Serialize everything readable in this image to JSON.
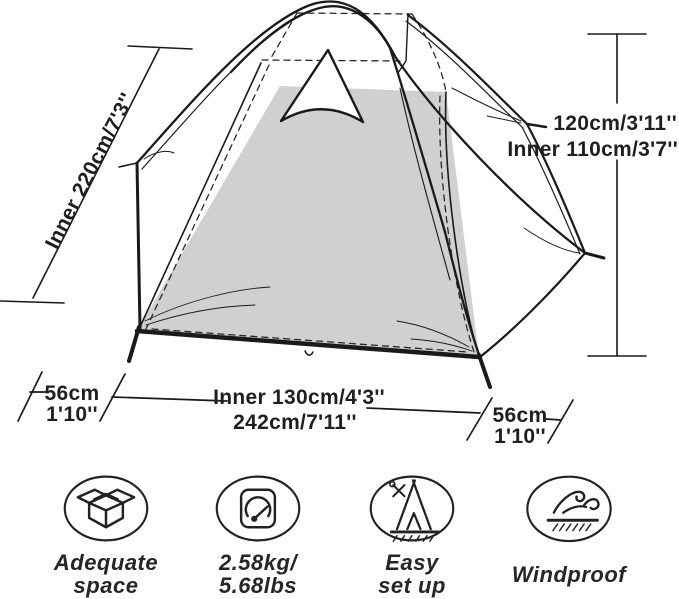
{
  "title": "tent-dimension-diagram",
  "colors": {
    "line": "#1a1a1a",
    "floor_fill": "#d0d0d0",
    "text": "#1f1f1f",
    "background": "#ffffff"
  },
  "diagram": {
    "ridge_label": "Inner 220cm/7'3''",
    "height_label": "120cm/3'11''",
    "inner_height_label": "Inner 110cm/3'7''",
    "left_vestibule": {
      "cm": "56cm",
      "ft": "1'10''"
    },
    "inner_width_label": "Inner 130cm/4'3''",
    "total_width_label": "242cm/7'11''",
    "right_vestibule": {
      "cm": "56cm",
      "ft": "1'10''"
    }
  },
  "features": [
    {
      "icon": "open-box-icon",
      "lines": [
        "Adequate",
        "space"
      ]
    },
    {
      "icon": "scale-icon",
      "lines": [
        "2.58kg/",
        "5.68lbs"
      ]
    },
    {
      "icon": "tent-setup-icon",
      "lines": [
        "Easy",
        "set up"
      ]
    },
    {
      "icon": "windproof-icon",
      "lines": [
        "Windproof",
        ""
      ]
    }
  ]
}
